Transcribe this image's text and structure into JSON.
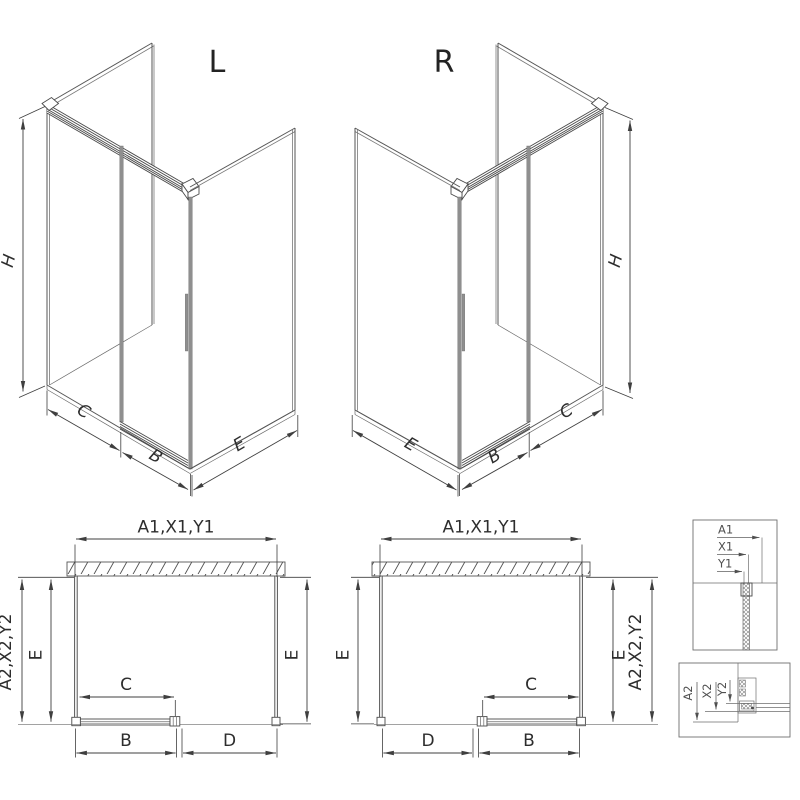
{
  "colors": {
    "line": "#565656",
    "dimension_line": "#3f3f3f",
    "glass_edge_gray": "#8f8f8f",
    "detail_line": "#6e6e6e",
    "background": "#ffffff"
  },
  "iso_left": {
    "title": "L",
    "dim_height": "H",
    "dim_front_fixed": "C",
    "dim_front_door": "B",
    "dim_side": "E"
  },
  "iso_right": {
    "title": "R",
    "dim_height": "H",
    "dim_side": "E",
    "dim_front_door": "B",
    "dim_front_fixed": "C"
  },
  "plan_left": {
    "dim_top": "A1,X1,Y1",
    "dim_left_outer": "A2,X2,Y2",
    "dim_left_depth": "E",
    "dim_right_depth": "E",
    "dim_door": "C",
    "dim_bottom_left": "B",
    "dim_bottom_right": "D"
  },
  "plan_middle": {
    "dim_top": "A1,X1,Y1",
    "dim_left_depth": "E",
    "dim_right_depth": "E",
    "dim_right_outer": "A2,X2,Y2",
    "dim_door": "C",
    "dim_bottom_left": "D",
    "dim_bottom_right": "B"
  },
  "detail_top": {
    "dim_1": "A1",
    "dim_2": "X1",
    "dim_3": "Y1"
  },
  "detail_bottom": {
    "dim_1": "A2",
    "dim_2": "X2",
    "dim_3": "Y2"
  }
}
